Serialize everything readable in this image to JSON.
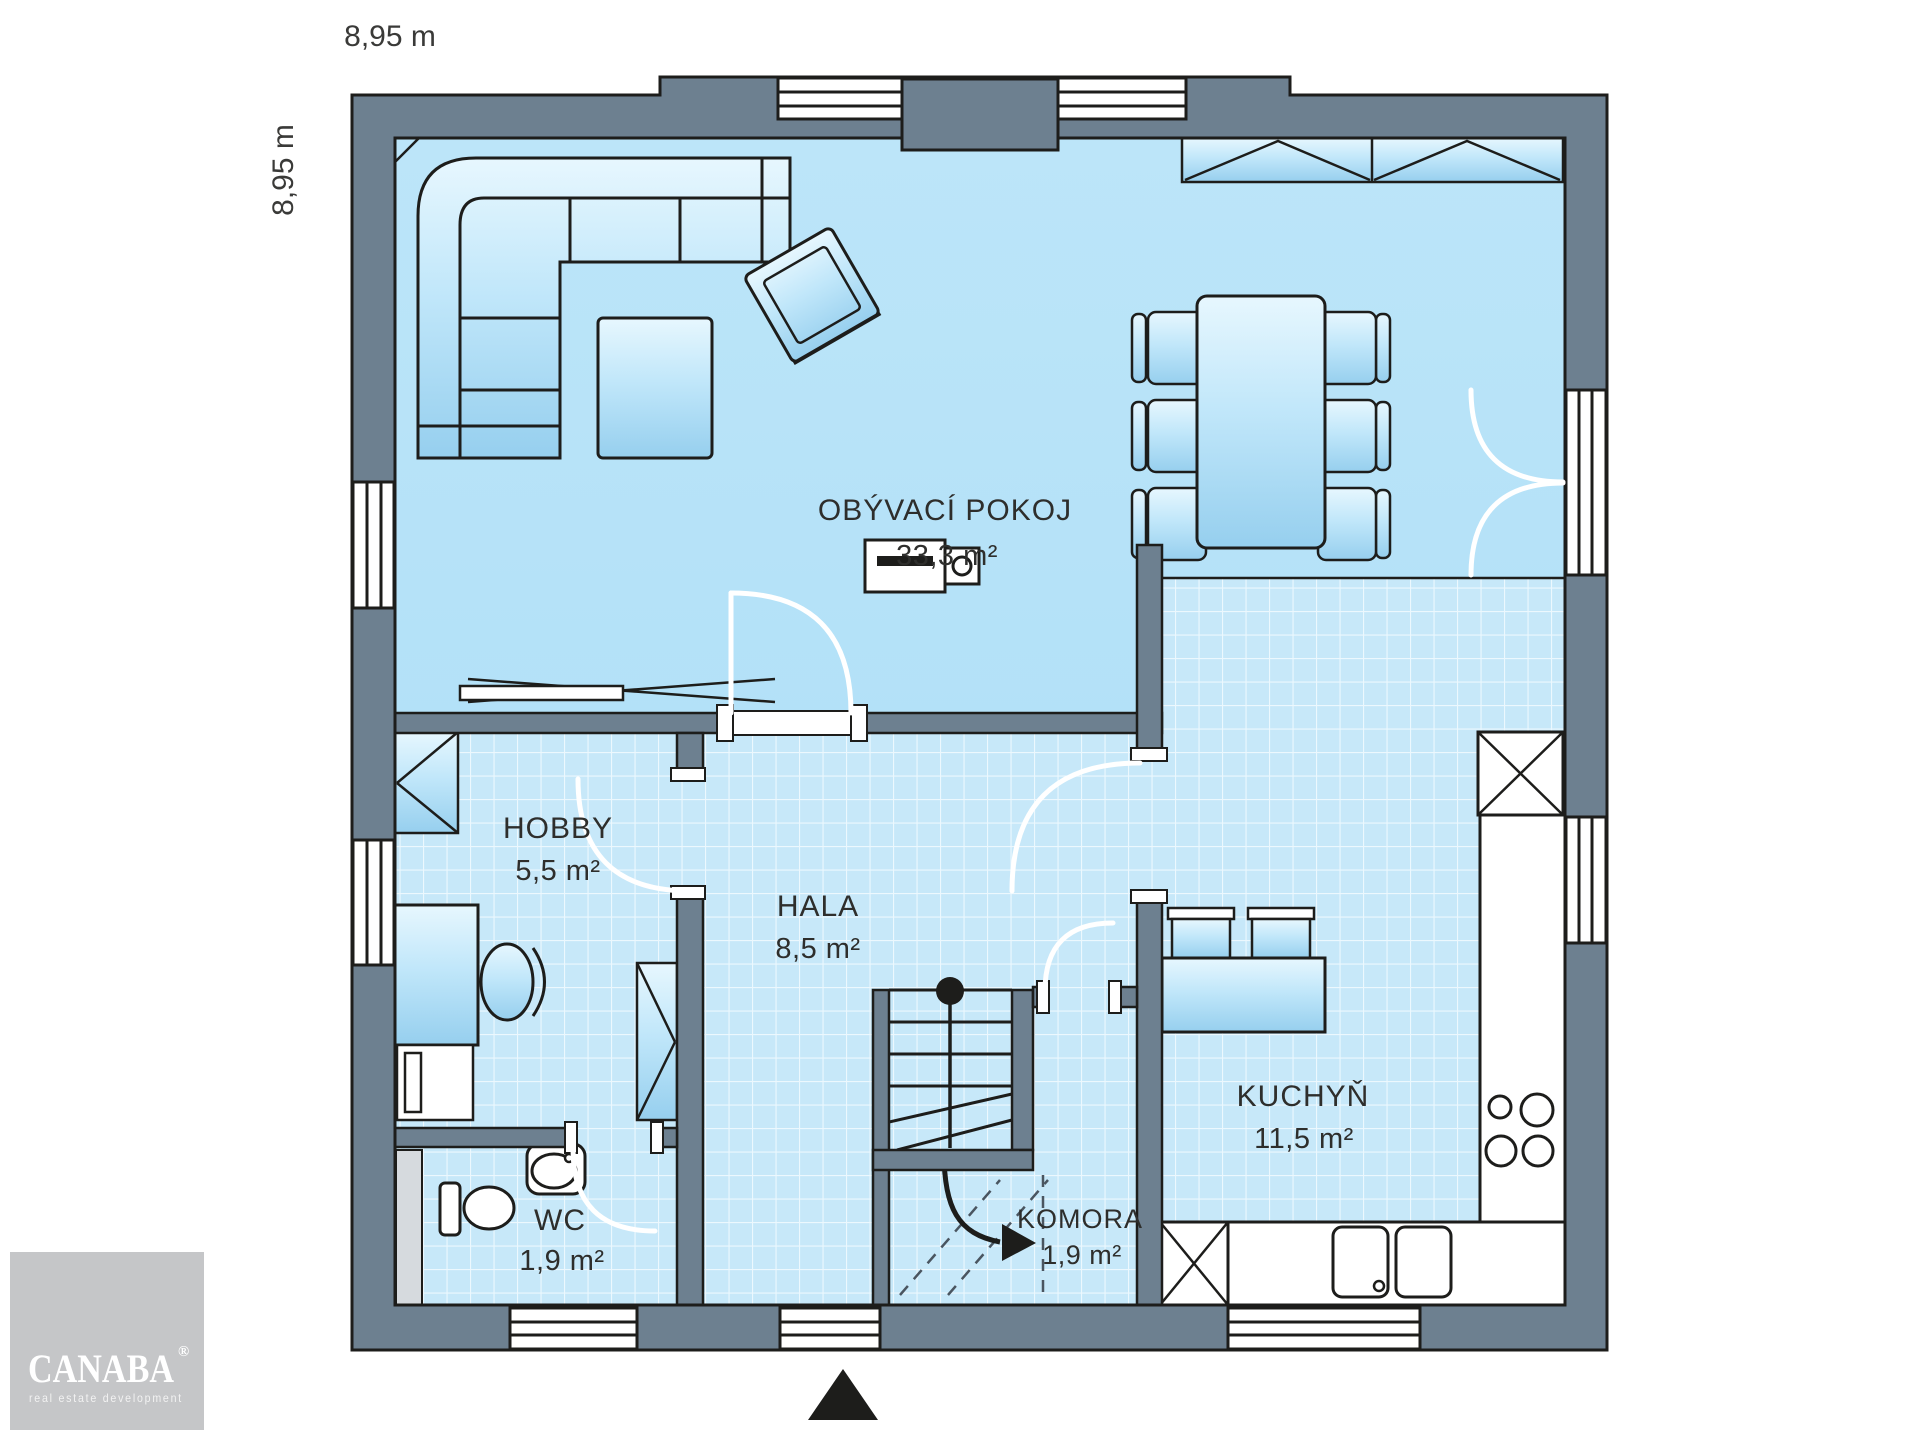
{
  "dimensions": {
    "width_label": "8,95 m",
    "height_label": "8,95 m"
  },
  "rooms": [
    {
      "id": "obyvaci-pokoj",
      "name": "OBÝVACÍ POKOJ",
      "area": "33,3 m²"
    },
    {
      "id": "hobby",
      "name": "HOBBY",
      "area": "5,5 m²"
    },
    {
      "id": "hala",
      "name": "HALA",
      "area": "8,5 m²"
    },
    {
      "id": "wc",
      "name": "WC",
      "area": "1,9 m²"
    },
    {
      "id": "komora",
      "name": "KOMORA",
      "area": "1,9 m²"
    },
    {
      "id": "kuchyn",
      "name": "KUCHYŇ",
      "area": "11,5 m²"
    }
  ],
  "logo": {
    "brand": "CANABA",
    "registered": "®",
    "tagline": "real estate development"
  },
  "colors": {
    "wall": "#6d8090",
    "outline": "#1d1d1b",
    "floor": "#b4e1f8",
    "tile": "#c7e8f9",
    "logo_background": "#c5c6c8"
  }
}
